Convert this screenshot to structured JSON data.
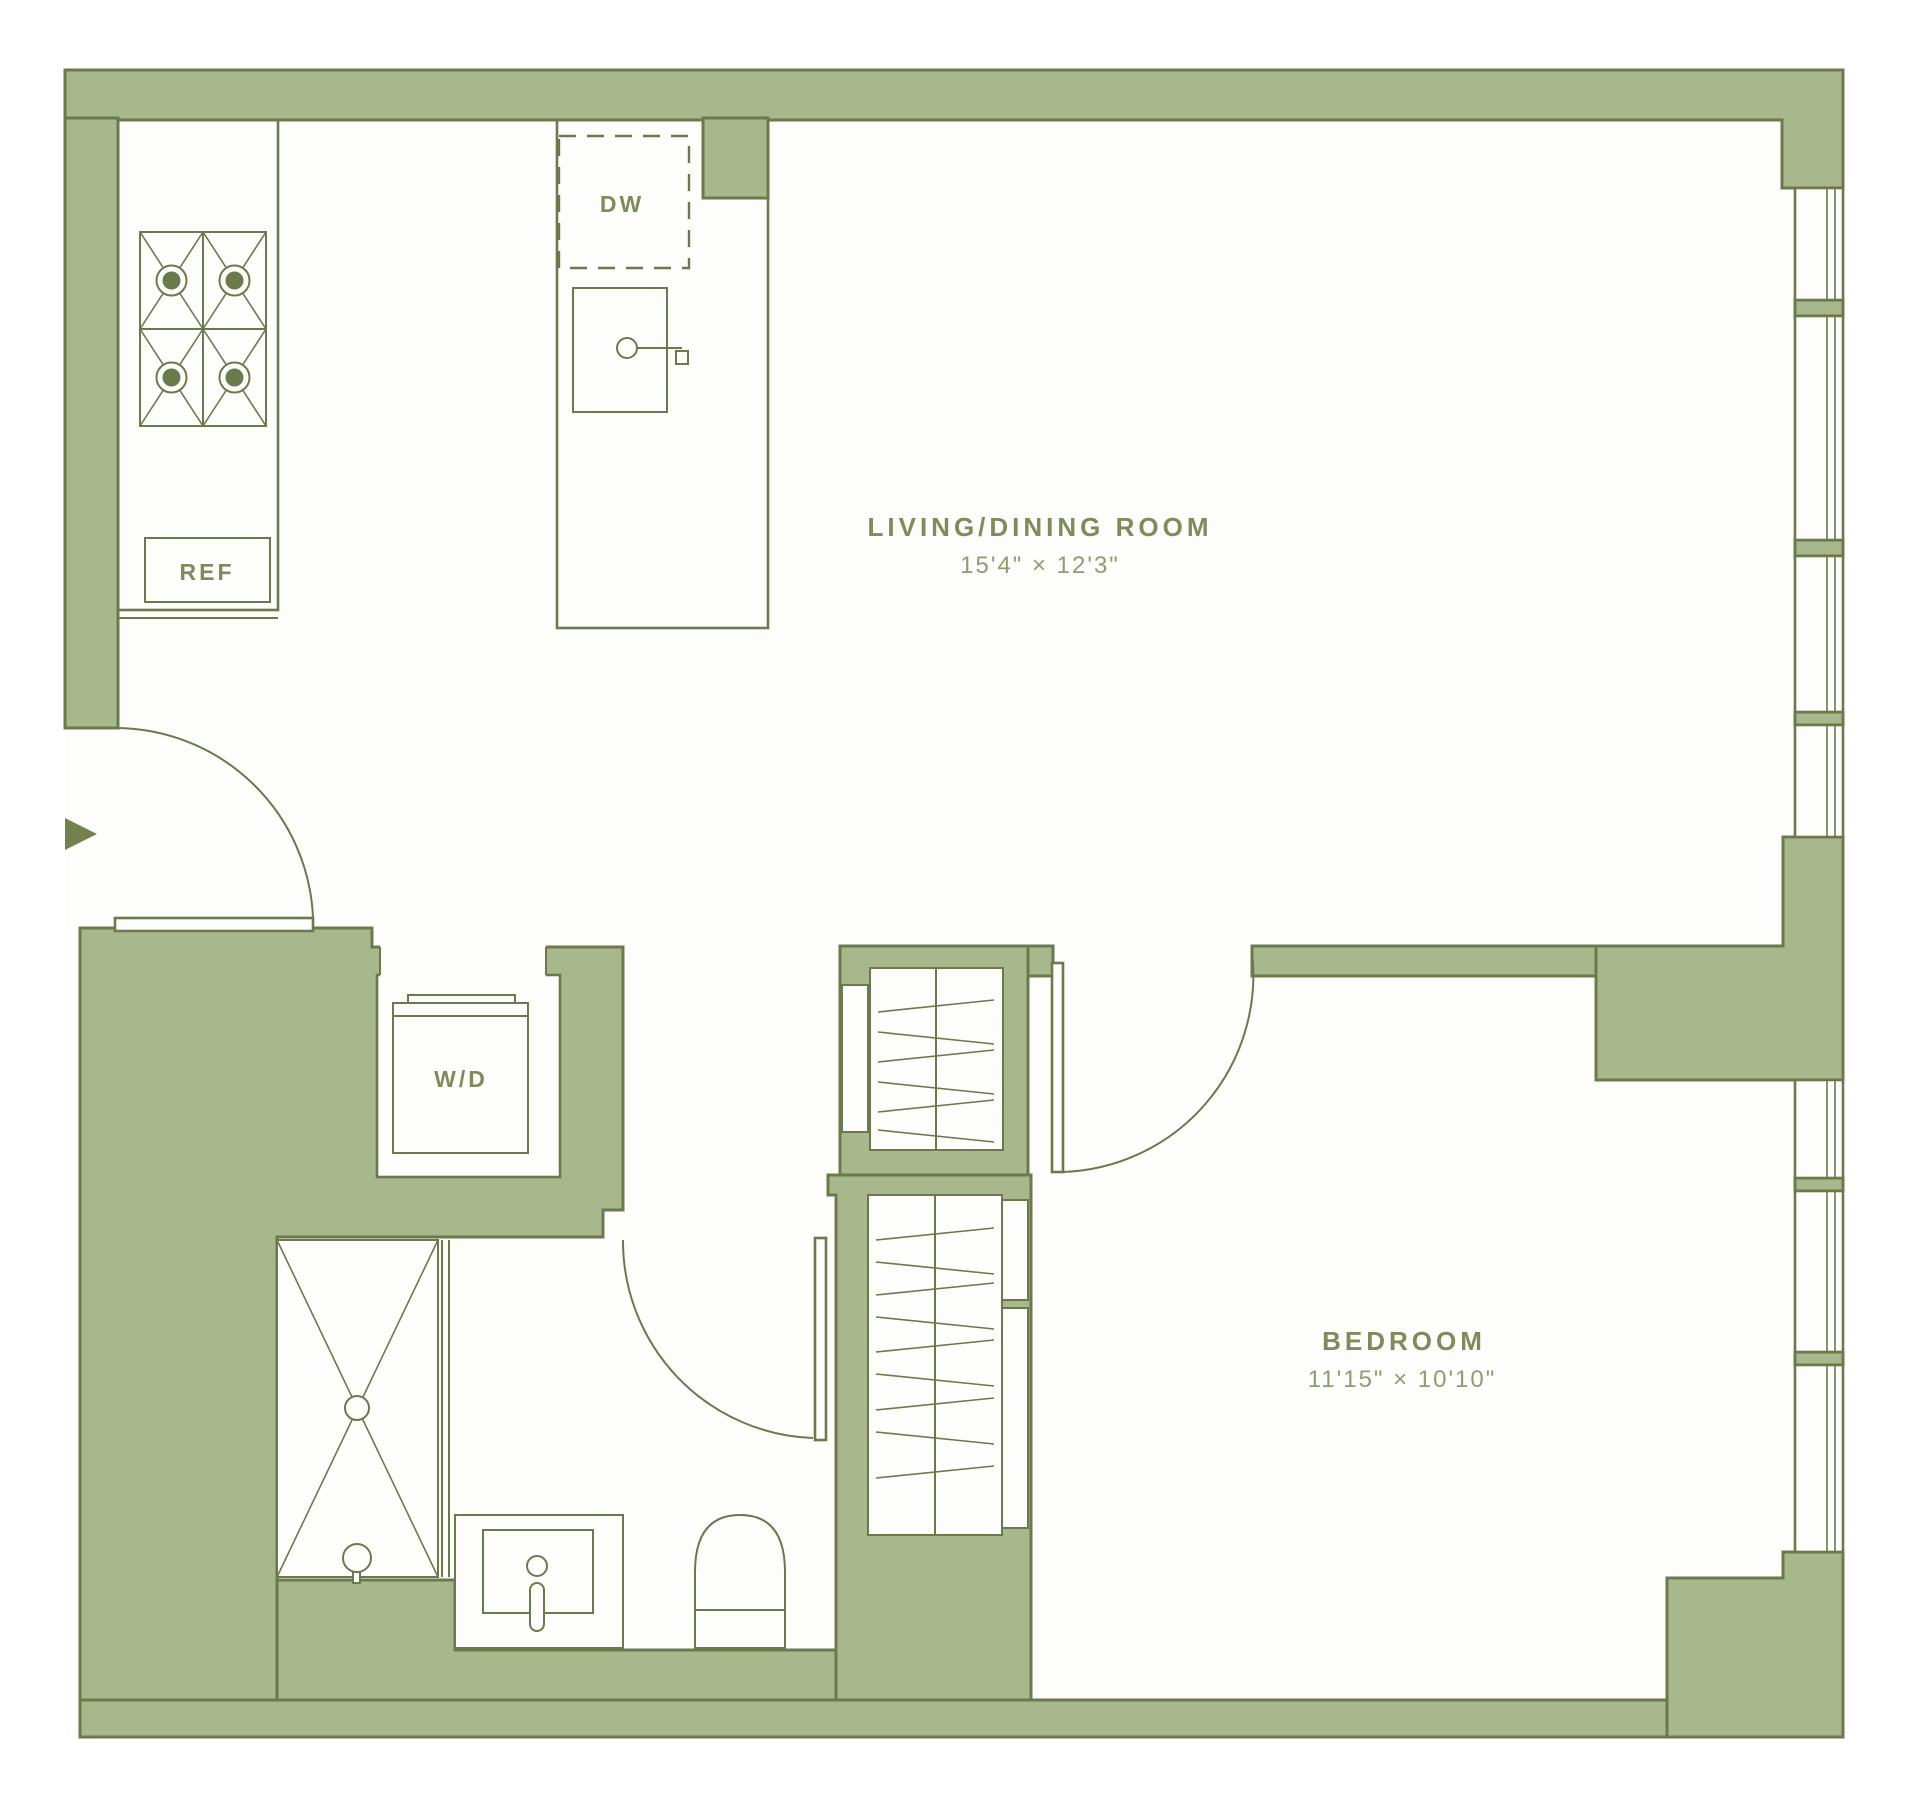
{
  "colors": {
    "wall": "#a9b78c",
    "wall_outline": "#6b7a4b",
    "room_label": "#7d8c58",
    "dimension_label": "#8e9d6e",
    "floor": "#fdfdfb",
    "entry_arrow": "#72814d"
  },
  "rooms": {
    "living_dining": {
      "name": "LIVING/DINING ROOM",
      "dimensions": "15'4\" × 12'3\""
    },
    "bedroom": {
      "name": "BEDROOM",
      "dimensions": "11'15\" × 10'10\""
    }
  },
  "appliances": {
    "dishwasher": "DW",
    "refrigerator": "REF",
    "washer_dryer": "W/D"
  }
}
